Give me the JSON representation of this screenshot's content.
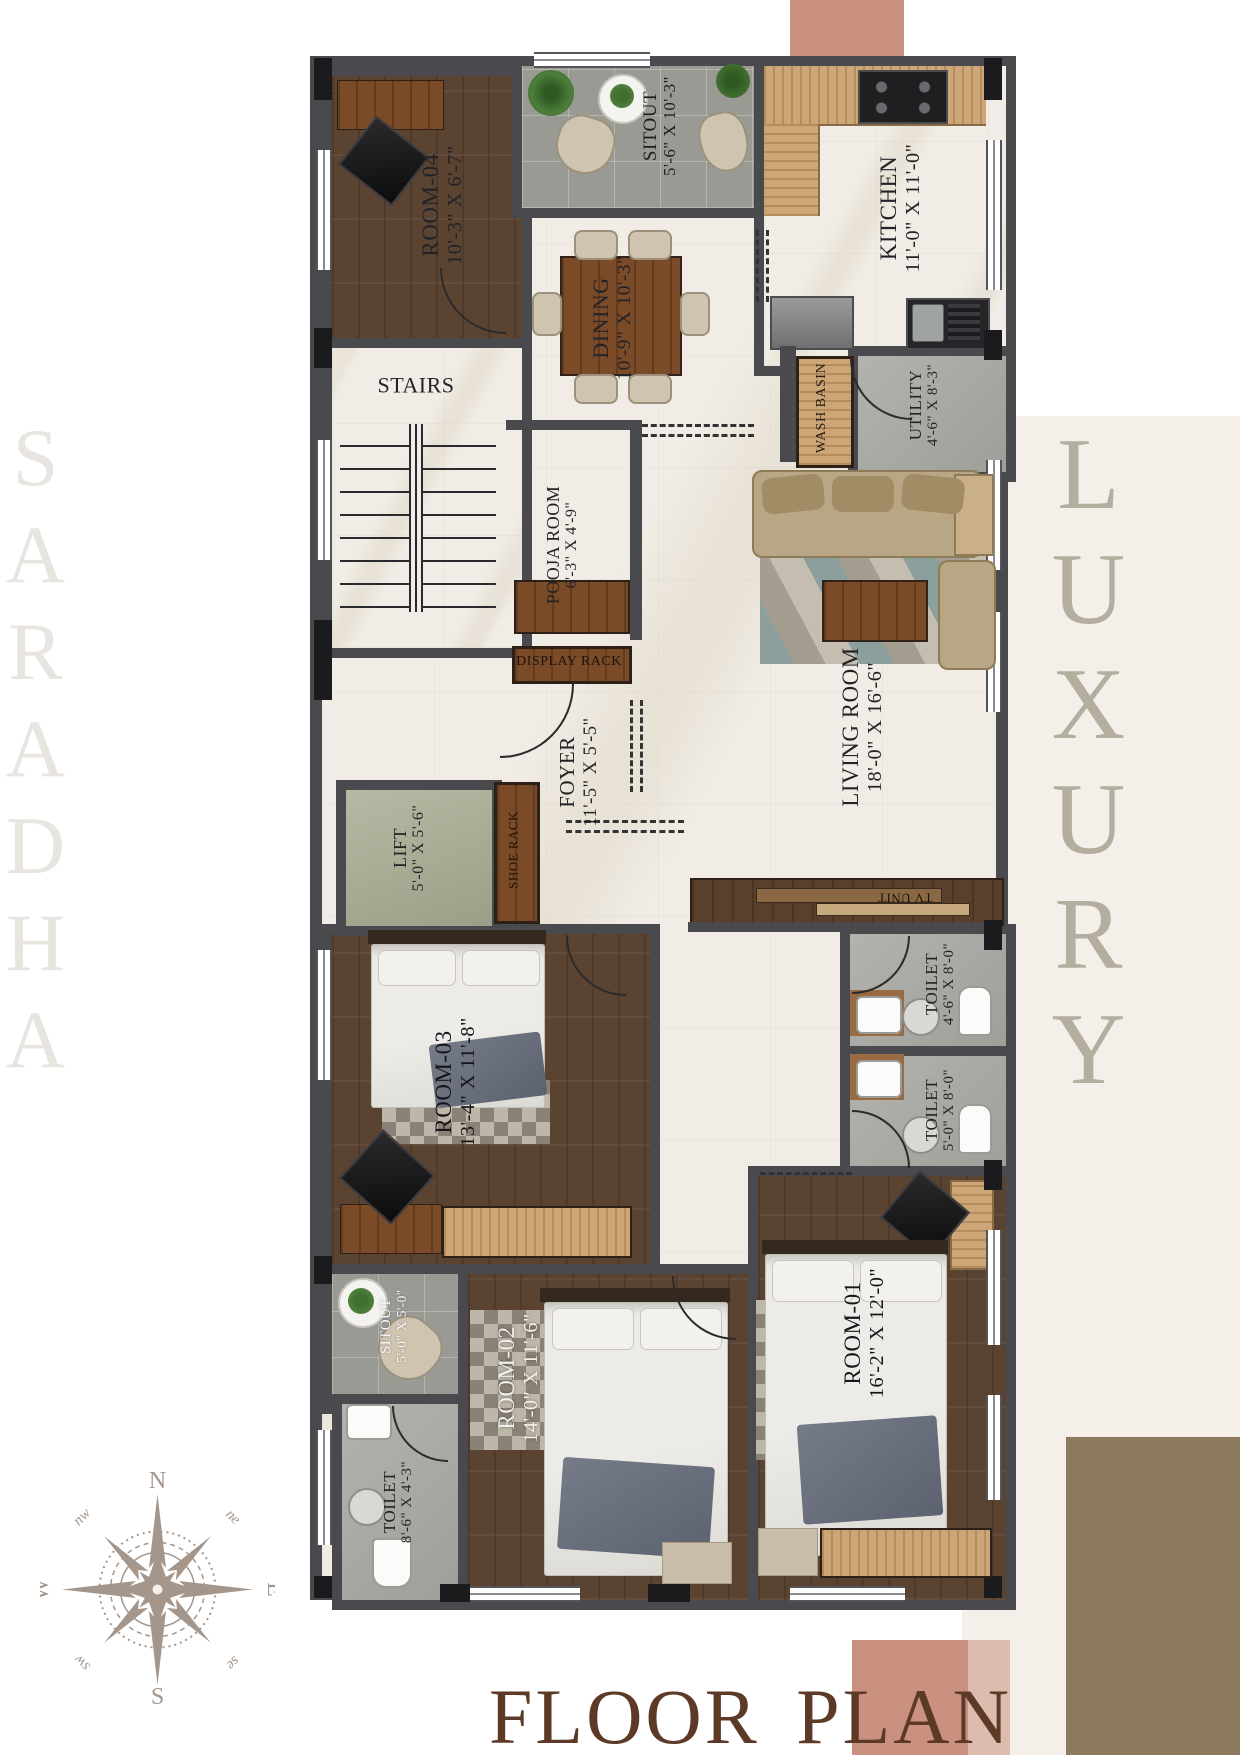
{
  "branding": {
    "project_watermark": "SARADHA",
    "side_watermark": "LUXURY",
    "title": "FLOOR PLAN"
  },
  "compass": {
    "n": "N",
    "e": "E",
    "s": "S",
    "w": "W",
    "ne": "ne",
    "nw": "nw",
    "se": "se",
    "sw": "sw"
  },
  "rooms": {
    "room04": {
      "name": "ROOM-04",
      "dims": "10'-3\" X 6'-7\""
    },
    "sitout_top": {
      "name": "SITOUT",
      "dims": "5'-6\" X 10'-3\""
    },
    "kitchen": {
      "name": "KITCHEN",
      "dims": "11'-0\" X 11'-0\""
    },
    "dining": {
      "name": "DINING",
      "dims": "10'-9\" X 10'-3\""
    },
    "stairs": {
      "name": "STAIRS"
    },
    "wash_basin": {
      "name": "WASH BASIN"
    },
    "utility": {
      "name": "UTILITY",
      "dims": "4'-6\" X 8'-3\""
    },
    "pooja_room": {
      "name": "POOJA ROOM",
      "dims": "6'-3\" X 4'-9\""
    },
    "display_rack": {
      "name": "DISPLAY RACK"
    },
    "foyer": {
      "name": "FOYER",
      "dims": "11'-5\" X 5'-5\""
    },
    "lift": {
      "name": "LIFT",
      "dims": "5'-0\" X 5'-6\""
    },
    "shoe_rack": {
      "name": "SHOE RACK"
    },
    "living_room": {
      "name": "LIVING ROOM",
      "dims": "18'-0\" X 16'-6\""
    },
    "tv_unit": {
      "name": "TV UNIT"
    },
    "toilet_top": {
      "name": "TOILET",
      "dims": "4'-6\" X 8'-0\""
    },
    "toilet_mid": {
      "name": "TOILET",
      "dims": "5'-0\" X 8'-0\""
    },
    "room03": {
      "name": "ROOM-03",
      "dims": "13'-4\" X 11'-8\""
    },
    "sitout_small": {
      "name": "SITOUT",
      "dims": "5'-0\" X 5'-0\""
    },
    "toilet_left": {
      "name": "TOILET",
      "dims": "8'-6\" X 4'-3\""
    },
    "room02": {
      "name": "ROOM-02",
      "dims": "14'-0\" X 11'-6\""
    },
    "room01": {
      "name": "ROOM-01",
      "dims": "16'-2\" X 12'-0\""
    }
  },
  "colors": {
    "accent_salmon": "#c9907f",
    "accent_blush": "#dcbcae",
    "accent_cream": "#f4efe8",
    "accent_olive": "#8b7a5e",
    "title_brown": "#5d3a28",
    "wall_gray": "#4a494d",
    "lift_sage": "#a9ad93",
    "compass_taupe": "#a5968c"
  }
}
